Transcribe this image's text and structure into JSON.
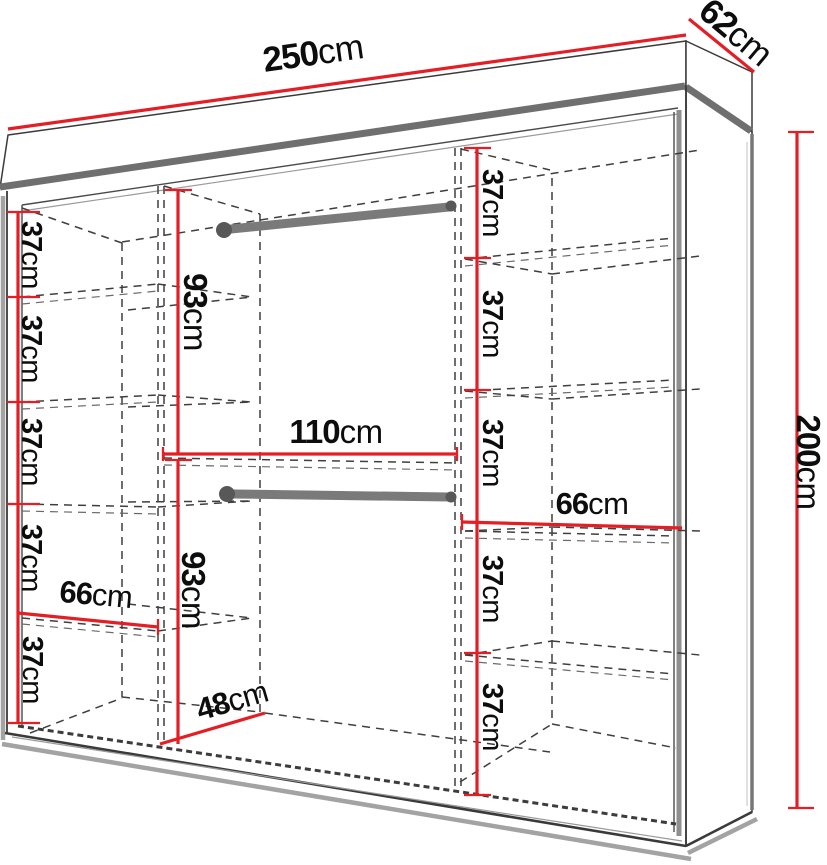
{
  "figure": {
    "type": "furniture-dimension-diagram",
    "subject": "wardrobe interior dimensions"
  },
  "units": "cm",
  "overall_dimensions": {
    "width": {
      "value": "250",
      "unit": "cm"
    },
    "depth": {
      "value": "62",
      "unit": "cm"
    },
    "height": {
      "value": "200",
      "unit": "cm"
    }
  },
  "left_column": {
    "section_heights": [
      {
        "value": "37",
        "unit": "cm"
      },
      {
        "value": "37",
        "unit": "cm"
      },
      {
        "value": "37",
        "unit": "cm"
      },
      {
        "value": "37",
        "unit": "cm"
      },
      {
        "value": "37",
        "unit": "cm"
      }
    ],
    "shelf_width": {
      "value": "66",
      "unit": "cm"
    }
  },
  "middle_section": {
    "top_hanging_height": {
      "value": "93",
      "unit": "cm"
    },
    "bottom_hanging_height": {
      "value": "93",
      "unit": "cm"
    },
    "width": {
      "value": "110",
      "unit": "cm"
    },
    "floor_depth": {
      "value": "48",
      "unit": "cm"
    },
    "hanging_rods": 2
  },
  "right_column": {
    "section_heights": [
      {
        "value": "37",
        "unit": "cm"
      },
      {
        "value": "37",
        "unit": "cm"
      },
      {
        "value": "37",
        "unit": "cm"
      },
      {
        "value": "37",
        "unit": "cm"
      },
      {
        "value": "37",
        "unit": "cm"
      }
    ],
    "shelf_width": {
      "value": "66",
      "unit": "cm"
    }
  },
  "colors": {
    "dimension_red": "#e31e25",
    "cabinet_edge": "#3a3a3a",
    "cabinet_thick_gray": "#6f6f6f",
    "dash_gray": "#3f3f3f",
    "rod_gray": "#7a7a7a",
    "label_black": "#0d0d0d",
    "background": "#ffffff"
  }
}
